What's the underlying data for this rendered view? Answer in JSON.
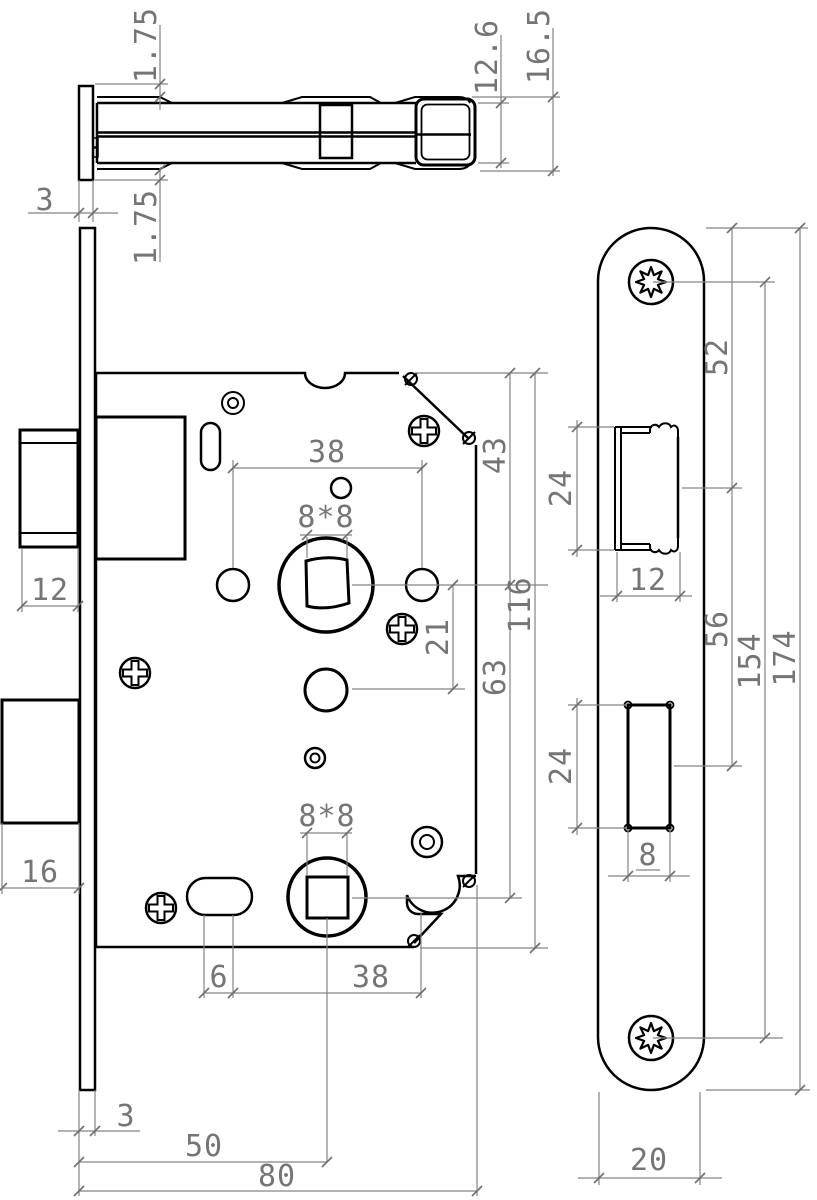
{
  "drawing": {
    "type": "technical-drawing",
    "subject": "mortise-lock-with-faceplate",
    "background": "#ffffff",
    "line_color": "#000000",
    "dimension_color": "#757575"
  },
  "dims": {
    "top": {
      "offset_top": "1.75",
      "inner_height": "12.6",
      "total_height": "16.5",
      "plate_thickness": "3",
      "offset_bottom": "1.75"
    },
    "front": {
      "handle_spacing_top": "38",
      "spindle_top": "8*8",
      "top_to_spindle": "43",
      "latch_width": "12",
      "spindle_to_cylinder": "21",
      "body_height": "116",
      "spindle_to_spindle": "63",
      "deadbolt_width": "16",
      "spindle_bottom": "8*8",
      "slot_offset": "6",
      "handle_spacing_bottom": "38",
      "plate_thickness": "3",
      "backset": "50",
      "body_depth": "80"
    },
    "faceplate": {
      "top_to_latch": "52",
      "latch_height": "24",
      "latch_width": "12",
      "latch_to_deadbolt": "56",
      "screw_spacing": "154",
      "total_height": "174",
      "deadbolt_height": "24",
      "deadbolt_width": "8",
      "plate_width": "20"
    }
  }
}
